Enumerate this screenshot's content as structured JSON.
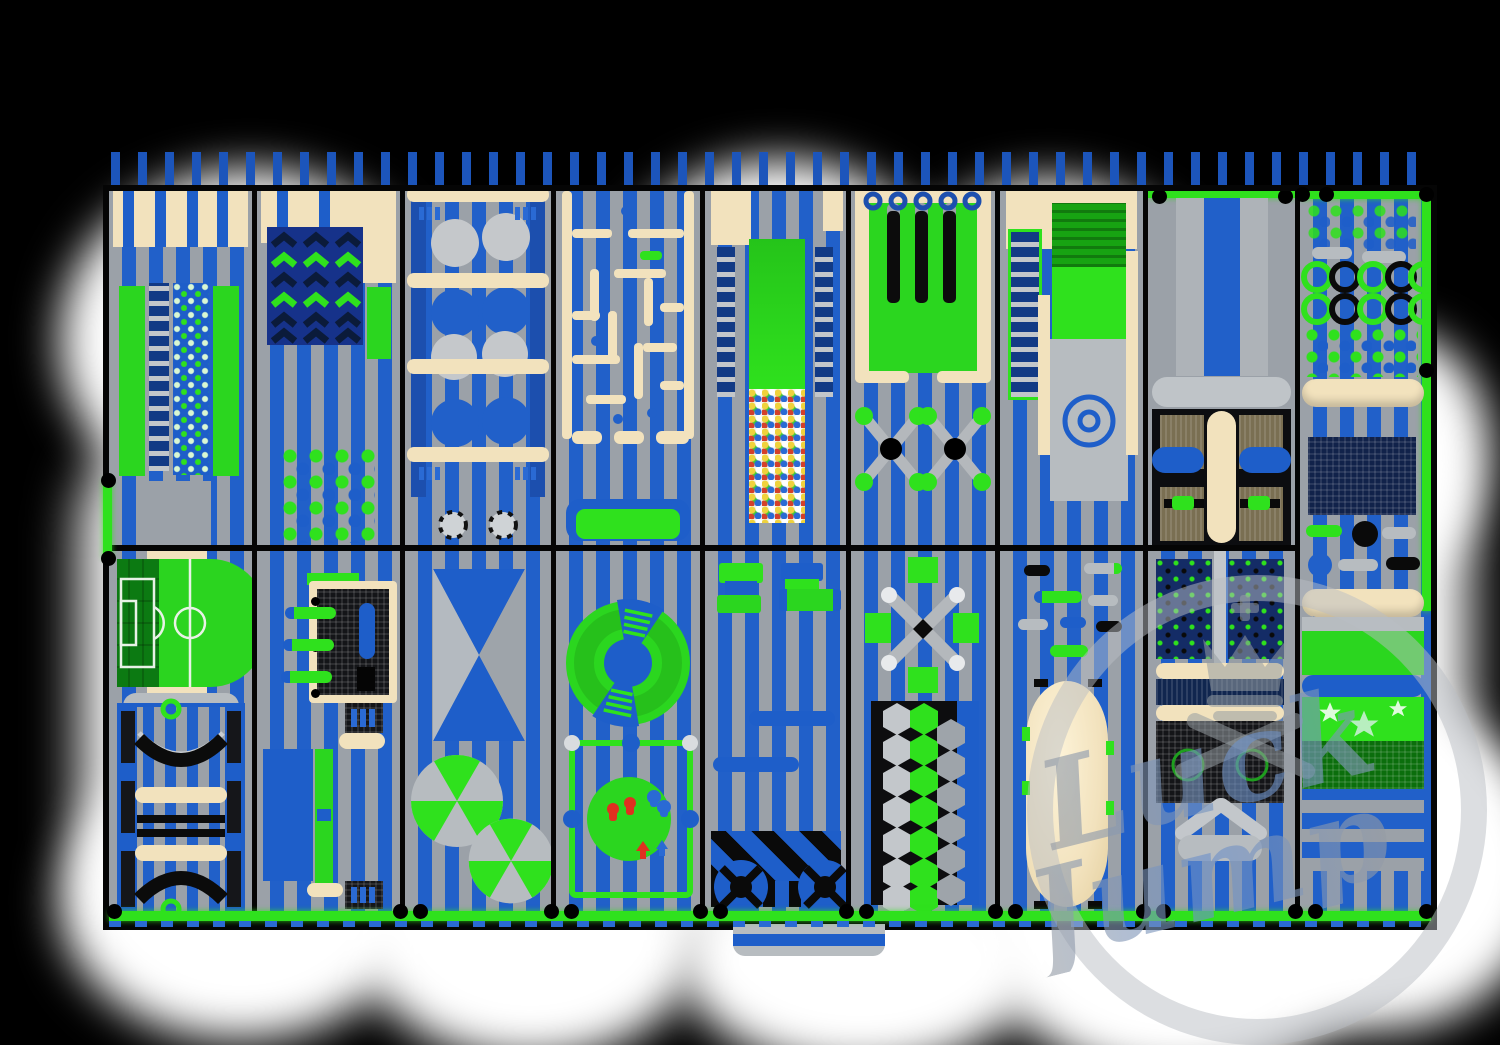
{
  "brand": {
    "watermark_line1": "Luck",
    "watermark_line1_tail": "y",
    "watermark_line2": "Jump"
  },
  "palette": {
    "background": "#000000",
    "cloud_white": "#ffffff",
    "floor_blue": "#2160c9",
    "floor_gray": "#9ba1a8",
    "post_blue": "#1c55bb",
    "accent_green": "#2fe11d",
    "mat_green": "#2bd61f",
    "beige": "#f2e2bd",
    "navy": "#123a85",
    "frame_black": "#0a0a0a",
    "court_green": "#28d41f",
    "court_mesh_green": "#0c7a12",
    "watermark_gray": "rgba(185,190,196,0.5)",
    "ballpit_colors": [
      "#f0d23c",
      "#ffffff",
      "#2a6ad4",
      "#d4402a",
      "#3fc93a"
    ]
  },
  "zones": [
    {
      "id": "climbing-wall",
      "desc": "padded climb wall with ladder, hold dots and green panels"
    },
    {
      "id": "chevron-wall",
      "desc": "zigzag chevron climb panel with stepping-dot grid"
    },
    {
      "id": "giant-balls",
      "desc": "giant hanging balls obstacle frame with beige shelves"
    },
    {
      "id": "foam-maze",
      "desc": "soft-play maze with beige walls and landing pad"
    },
    {
      "id": "ball-pit-slide",
      "desc": "green slide into multicolor ball pit between ladders"
    },
    {
      "id": "punch-bag-lane",
      "desc": "framed green mat with punch bars and two cross spinners"
    },
    {
      "id": "roller-slide",
      "desc": "roller slide with gray run-out and target circles"
    },
    {
      "id": "cross-trampoline",
      "desc": "gray walkway and four-bed trampoline with beige cross"
    },
    {
      "id": "rings-obstacle-lane",
      "desc": "rings, pod dots, rollers, net panel, star slide lane"
    },
    {
      "id": "sports-court",
      "desc": "mini football court and trampoline lanes with arc banks"
    },
    {
      "id": "interactive-wall",
      "desc": "interactive game screen, pegs and green balance beam"
    },
    {
      "id": "wedge-bags",
      "desc": "blue wedge air bags and two green pinwheel mats"
    },
    {
      "id": "spin-wheel",
      "desc": "green spin wheel and fenced platform with play figures"
    },
    {
      "id": "soft-seating",
      "desc": "soft seats, blue beams and striped conveyor exit ramp"
    },
    {
      "id": "spinner-hex-bridge",
      "desc": "cross spinner with green pads and honeycomb bridge"
    },
    {
      "id": "stepper-foam-bag",
      "desc": "stepper capsules and giant beige foam bag"
    },
    {
      "id": "climb-panels-trampoline",
      "desc": "dot climb panels, rollers and net trampoline"
    },
    {
      "id": "star-slide-lane",
      "desc": "rollers, star mat slide and striped run-out"
    }
  ]
}
